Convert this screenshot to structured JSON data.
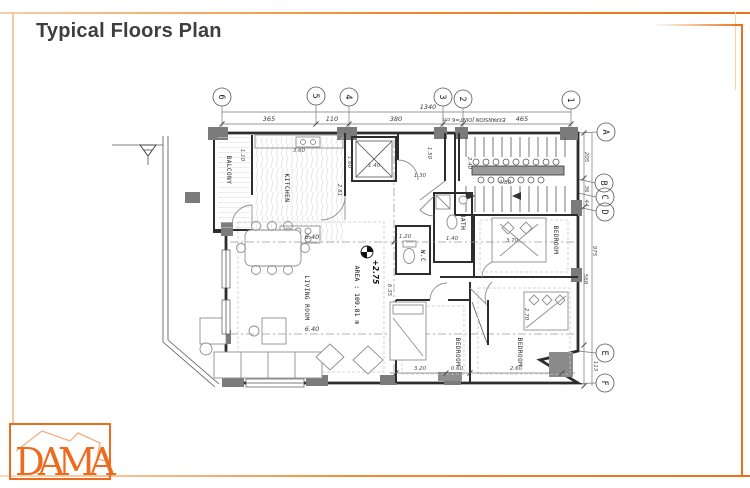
{
  "page": {
    "title": "Typical Floors Plan"
  },
  "logo": {
    "text": "DAMA"
  },
  "colors": {
    "accent": "#E8721A",
    "accent_light": "#F5C9A4",
    "wall": "#2D2D2D",
    "column": "#7B7B7B"
  },
  "plan": {
    "grid": {
      "cols": [
        "6",
        "5",
        "4",
        "3",
        "2",
        "1"
      ],
      "rows": [
        "A",
        "B",
        "C",
        "D",
        "E",
        "F"
      ]
    },
    "rooms": {
      "balcony": "BALCONY",
      "kitchen": "KITCHEN",
      "living": "LIVING ROOM",
      "bath": "BATH",
      "wc": "W.C",
      "bedroom_a": "BEDROOM",
      "bedroom_b": "BEDROOM",
      "bedroom_c": "BEDROOM"
    },
    "annotations": {
      "level": "+2.75",
      "area": "AREA : 109.81 m",
      "expansion": "EXPANSION JOINT=6 cm"
    },
    "dims": {
      "overall_top": "1340",
      "t1": "365",
      "t2": "110",
      "t3": "380",
      "t4": "465",
      "r_205": "205",
      "r_36": "36",
      "r_44": "44",
      "r_975": "975",
      "r_568": "568",
      "r_113": "113",
      "living_w": "6.40",
      "living_h": "6.35",
      "stair": "4.80",
      "elev_w": "1.40",
      "elev_h": "1.60",
      "hall1": "1.30",
      "hall2": "1.50",
      "hall3": "2.40",
      "bath_w": "1.40",
      "bed_a_w": "3.70",
      "wc_w": "1.20",
      "kitchen_w": "3.60",
      "kitchen_h": "2.81",
      "balcony_w": "1.10",
      "bot1": "3.20",
      "bot2": "0.60",
      "bot3": "2.60",
      "bot4": "2.70"
    }
  }
}
